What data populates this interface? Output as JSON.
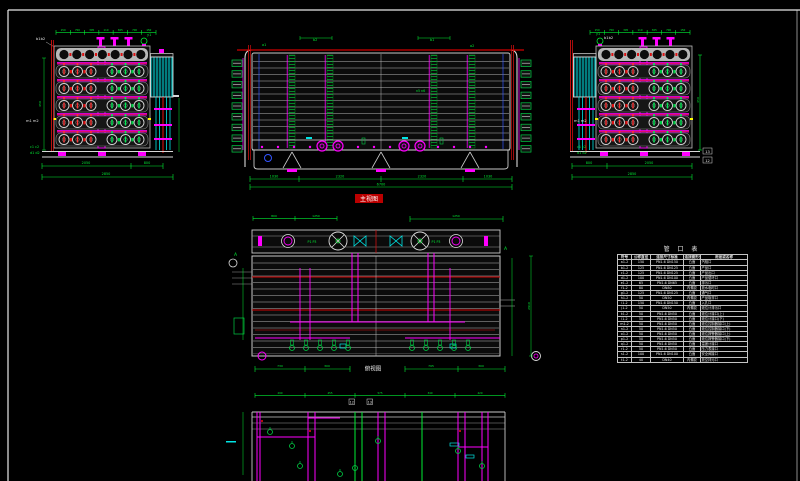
{
  "sheet": {
    "background": "#000000",
    "border_color": "#e8e8e8"
  },
  "colors": {
    "dim_green": "#00ee33",
    "magenta": "#ff00ff",
    "red": "#ee1111",
    "cyan": "#00e5e5",
    "white": "#e8e8e8",
    "gray": "#9a9a9a",
    "blue": "#3355ff",
    "title_highlight": "#bb0000"
  },
  "left_view": {
    "top_ticks": [
      "150",
      "700",
      "305",
      "110",
      "305",
      "700",
      "150"
    ],
    "b_label": "b1b2",
    "y_label": "y1",
    "m_label": "m1 m2",
    "c_label": "c1 c2",
    "d_label": "d1 d2",
    "height_dim": "450",
    "dim_seg1": "2050",
    "dim_seg2": "800",
    "dim_total": "2850"
  },
  "main_view": {
    "title": "主视图",
    "a1": "a1",
    "b2": "b2",
    "b1": "b1",
    "a2": "a2",
    "n_label": "n5 n6",
    "dim_segs": [
      "1030",
      "2320",
      "2320",
      "1030"
    ],
    "dim_total": "6700"
  },
  "right_view": {
    "top_ticks": [
      "150",
      "700",
      "305",
      "110",
      "305",
      "700",
      "150"
    ],
    "b_label": "b1b2",
    "y_label": "y1",
    "m_label": "m1 m2",
    "c_label": "c1 c2",
    "d_label": "d1 d2",
    "side_dim": "450",
    "part_a": "13",
    "part_b": "12",
    "dim_seg1": "800",
    "dim_seg2": "2050",
    "dim_total": "2850"
  },
  "plan_view": {
    "title": "俯视图",
    "a_marker": "A",
    "p_left": "P1 P3",
    "p_right": "P1 P3",
    "top_dims_left": [
      "800",
      "1250"
    ],
    "top_dim_right": "1250",
    "right_dim": "2910",
    "bottom_dims": [
      "730",
      "300",
      "795",
      "300"
    ]
  },
  "bottom_view": {
    "top_ticks": [
      "290",
      "455",
      "575",
      "340",
      "420"
    ],
    "tick_a": "12",
    "tick_b": "13"
  },
  "nozzle_table": {
    "title": "管 口 表",
    "headers": [
      "符号",
      "公称直径",
      "连接尺寸标准",
      "连接面形式",
      "用途或名称"
    ],
    "rows": [
      [
        "a1-2",
        "150",
        "PN1.6 DN150",
        "凸面",
        "汽相口"
      ],
      [
        "b1-2",
        "125",
        "PN1.6 DN125",
        "凸面",
        "产品口"
      ],
      [
        "c1-2",
        "125",
        "PN1.6 DN125",
        "凸面",
        "产品出口"
      ],
      [
        "d1-2",
        "100",
        "PN1.6 DN100",
        "凸面",
        "产品循环口"
      ],
      [
        "e1-2",
        "65",
        "PN1.6 DN65",
        "凸面",
        "排污口"
      ],
      [
        "f1-2",
        "80",
        "DN80",
        "内螺纹",
        "放水临时口"
      ],
      [
        "g1-2",
        "125",
        "PN1.6 DN125",
        "凸面",
        "通气口"
      ],
      [
        "h1-2",
        "50",
        "DN50",
        "内螺纹",
        "产品取样口"
      ],
      [
        "i1-2",
        "150",
        "PN1.6 DN150",
        "凸面",
        "入孔口"
      ],
      [
        "j1-2",
        "50",
        "DN50",
        "内螺纹",
        "液位计排污口"
      ],
      [
        "k1-2",
        "50",
        "PN1.6 DN50",
        "凸面",
        "液位计接口(上)"
      ],
      [
        "l1-2",
        "50",
        "PN1.6 DN50",
        "凸面",
        "液位计接口(下)"
      ],
      [
        "m1-2",
        "50",
        "PN1.6 DN50",
        "凸面",
        "液位控制器接口(上)"
      ],
      [
        "n1-2",
        "50",
        "PN1.6 DN50",
        "凸面",
        "液位控制器接口(下)"
      ],
      [
        "o1-2",
        "50",
        "PN1.6 DN50",
        "凸面",
        "液位报警器接口(上)"
      ],
      [
        "p1-2",
        "50",
        "PN1.6 DN50",
        "凸面",
        "液位报警器接口(下)"
      ],
      [
        "q1-2",
        "50",
        "PN1.6 DN50",
        "凸面",
        "温度计接口"
      ],
      [
        "r1-2",
        "50",
        "PN1.6 DN50",
        "凸面",
        "压力表接口"
      ],
      [
        "s1-2",
        "100",
        "PN1.6 DN100",
        "凸面",
        "安全阀接口"
      ],
      [
        "t1-2",
        "40",
        "DN40",
        "内螺纹",
        "放空排污口"
      ]
    ]
  }
}
